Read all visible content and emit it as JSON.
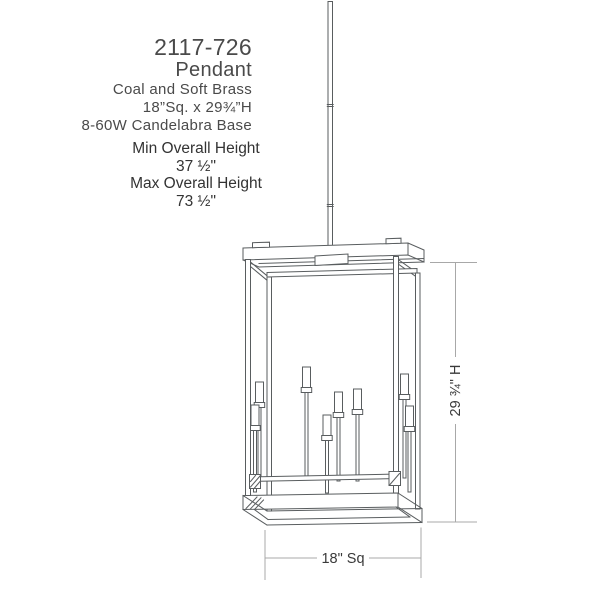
{
  "spec_block": {
    "model": "2117-726",
    "category": "Pendant",
    "finish": "Coal and Soft Brass",
    "size": "18”Sq. x 29¾”H",
    "lamping": "8-60W Candelabra Base"
  },
  "height_block": {
    "min_label": "Min Overall Height",
    "min_value": "37 ½\"",
    "max_label": "Max Overall Height",
    "max_value": "73 ½\""
  },
  "drawing_dimensions": {
    "height_label": "29 ¾\" H",
    "width_label": "18\" Sq"
  },
  "colors": {
    "drawing_line": "#595d5f",
    "dimension_line": "#a8a8a8",
    "spec_text": "#4a4a4a",
    "height_text": "#333333",
    "dimension_text": "#3a3a3a",
    "background": "#ffffff"
  }
}
